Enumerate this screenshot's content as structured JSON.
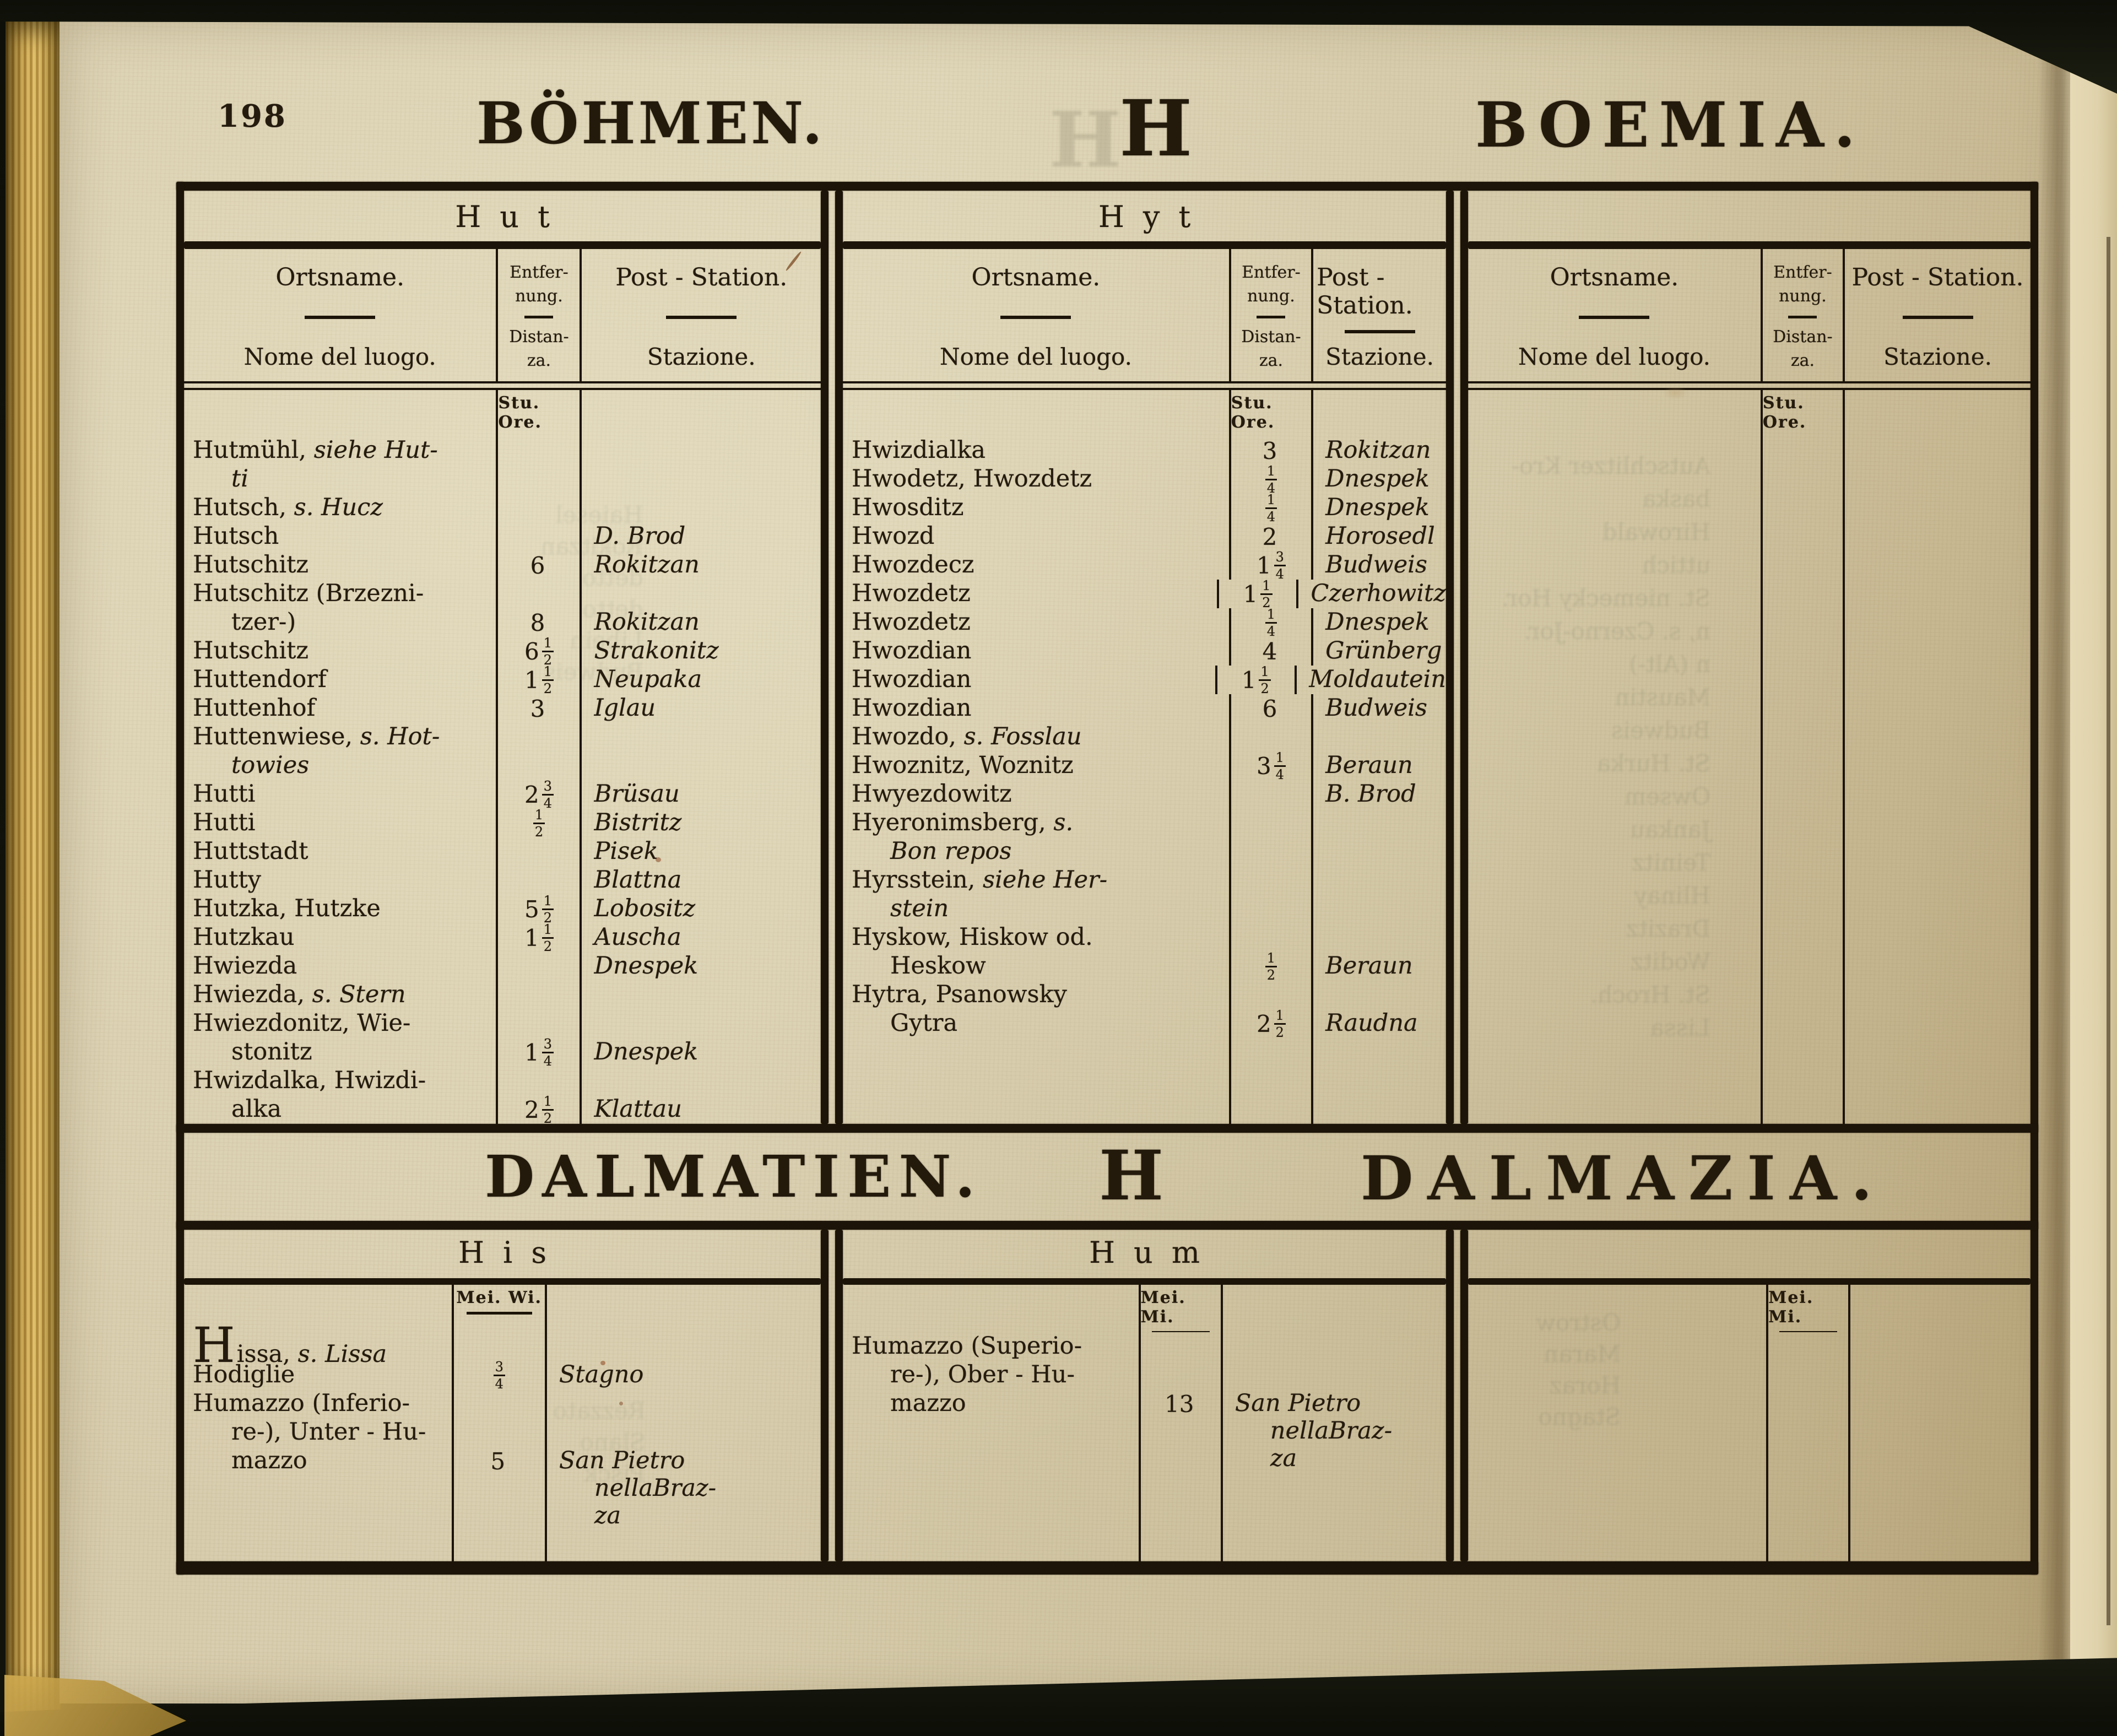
{
  "page_number": "198",
  "header": {
    "title_de": "BÖHMEN.",
    "letter": "H",
    "title_it": "BOEMIA."
  },
  "section_dalmatia": {
    "title_de": "DALMATIEN.",
    "letter": "H",
    "title_it": "DALMAZIA."
  },
  "column_headers": {
    "name_de": "Ortsname.",
    "name_it": "Nome del luogo.",
    "dist_de_1": "Entfer-",
    "dist_de_2": "nung.",
    "dist_it_1": "Distan-",
    "dist_it_2": "za.",
    "station_de": "Post - Station.",
    "station_it": "Stazione.",
    "unit_hours": "Stu. Ore."
  },
  "bohemia_tables": [
    {
      "group": "Hut",
      "rows": [
        {
          "t": "Hutmühl, *siehe Hut-*"
        },
        {
          "t": "*ti*",
          "i": 1
        },
        {
          "t": "Hutsch, *s. Hucz*"
        },
        {
          "t": "Hutsch",
          "s": "D. Brod"
        },
        {
          "t": "Hutschitz",
          "d": "6",
          "s": "Rokitzan"
        },
        {
          "t": "Hutschitz (Brzezni-"
        },
        {
          "t": "tzer-)",
          "i": 1,
          "d": "8",
          "s": "Rokitzan"
        },
        {
          "t": "Hutschitz",
          "d": "6 1/2",
          "s": "Strakonitz"
        },
        {
          "t": "Huttendorf",
          "d": "1 1/2",
          "s": "Neupaka"
        },
        {
          "t": "Huttenhof",
          "d": "3",
          "s": "Iglau"
        },
        {
          "t": "Huttenwiese, *s. Hot-*"
        },
        {
          "t": "*towies*",
          "i": 1
        },
        {
          "t": "Hutti",
          "d": "2 3/4",
          "s": "Brüsau"
        },
        {
          "t": "Hutti",
          "d": "1/2",
          "s": "Bistritz"
        },
        {
          "t": "Huttstadt",
          "s": "Pisek"
        },
        {
          "t": "Hutty",
          "s": "Blattna"
        },
        {
          "t": "Hutzka, Hutzke",
          "d": "5 1/2",
          "s": "Lobositz"
        },
        {
          "t": "Hutzkau",
          "d": "1 1/2",
          "s": "Auscha"
        },
        {
          "t": "Hwiezda",
          "s": "Dnespek"
        },
        {
          "t": "Hwiezda, *s. Stern*"
        },
        {
          "t": "Hwiezdonitz, Wie-"
        },
        {
          "t": "stonitz",
          "i": 1,
          "d": "1 3/4",
          "s": "Dnespek"
        },
        {
          "t": "Hwizdalka, Hwizdi-"
        },
        {
          "t": "alka",
          "i": 1,
          "d": "2 1/2",
          "s": "Klattau"
        }
      ]
    },
    {
      "group": "Hyt",
      "rows": [
        {
          "t": "Hwizdialka",
          "d": "3",
          "s": "Rokitzan"
        },
        {
          "t": "Hwodetz, Hwozdetz",
          "d": "1/4",
          "s": "Dnespek"
        },
        {
          "t": "Hwosditz",
          "d": "1/4",
          "s": "Dnespek"
        },
        {
          "t": "Hwozd",
          "d": "2",
          "s": "Horosedl"
        },
        {
          "t": "Hwozdecz",
          "d": "1 3/4",
          "s": "Budweis"
        },
        {
          "t": "Hwozdetz",
          "d": "1 1/2",
          "s": "Czerhowitz"
        },
        {
          "t": "Hwozdetz",
          "d": "1/4",
          "s": "Dnespek"
        },
        {
          "t": "Hwozdian",
          "d": "4",
          "s": "Grünberg"
        },
        {
          "t": "Hwozdian",
          "d": "1 1/2",
          "s": "Moldautein"
        },
        {
          "t": "Hwozdian",
          "d": "6",
          "s": "Budweis"
        },
        {
          "t": "Hwozdo, *s. Fosslau*"
        },
        {
          "t": "Hwoznitz, Woznitz",
          "d": "3 1/4",
          "s": "Beraun"
        },
        {
          "t": "Hwyezdowitz",
          "s": "B. Brod"
        },
        {
          "t": "Hyeronimsberg, *s.*"
        },
        {
          "t": "*Bon repos*",
          "i": 1
        },
        {
          "t": "Hyrsstein, *siehe Her-*"
        },
        {
          "t": "*stein*",
          "i": 1
        },
        {
          "t": "Hyskow, Hiskow od."
        },
        {
          "t": "Heskow",
          "i": 1,
          "d": "1/2",
          "s": "Beraun"
        },
        {
          "t": "Hytra, Psanowsky"
        },
        {
          "t": "Gytra",
          "i": 1,
          "d": "2 1/2",
          "s": "Raudna"
        }
      ]
    },
    {
      "group": "",
      "rows": []
    }
  ],
  "dalmatia_tables": [
    {
      "group": "His",
      "unit": "Mei. Wi.",
      "rows": [
        {
          "t": "Hissa, *s. Lissa*",
          "big": 1
        },
        {
          "t": "Hodiglie",
          "d": "3/4",
          "s": "Stagno"
        },
        {
          "t": "Humazzo (Inferio-"
        },
        {
          "t": "re-), Unter - Hu-",
          "i": 1
        },
        {
          "t": "mazzo",
          "i": 1,
          "d": "5",
          "s": [
            "San Pietro",
            "nellaBraz-",
            "za"
          ]
        }
      ]
    },
    {
      "group": "Hum",
      "unit": "Mei. Mi.",
      "rows": [
        {
          "t": "Humazzo (Superio-"
        },
        {
          "t": "re-), Ober - Hu-",
          "i": 1
        },
        {
          "t": "mazzo",
          "i": 1,
          "d": "13",
          "s": [
            "San Pietro",
            "nellaBraz-",
            "za"
          ]
        }
      ]
    },
    {
      "group": "",
      "unit": "Mei. Mi.",
      "rows": []
    }
  ],
  "bleedthrough": {
    "bohemia_col1": [
      "Haiesel",
      "Rokitzan",
      "detto",
      "detto",
      "Libein",
      "Budweis"
    ],
    "bohemia_col3": [
      "Autschlitzer Kro-",
      "baska",
      "Hirowald",
      "uttich",
      "St. niemecky Hor.",
      "n, s. Czerno-Jor.",
      "n (Alt-)",
      "Maustin",
      "Budweis",
      "St. Hurka",
      "Owsem",
      "Jankau",
      "Teinitz",
      "Hlinay",
      "Drazitz",
      "Woditz",
      "St. Hroch.",
      "Lissa"
    ],
    "dalmatia_col1": [
      "Rezzato",
      "Slano",
      "Pisck"
    ],
    "dalmatia_col3": [
      "Ostrow",
      "Maran",
      "Horaz",
      "Stagno"
    ]
  }
}
